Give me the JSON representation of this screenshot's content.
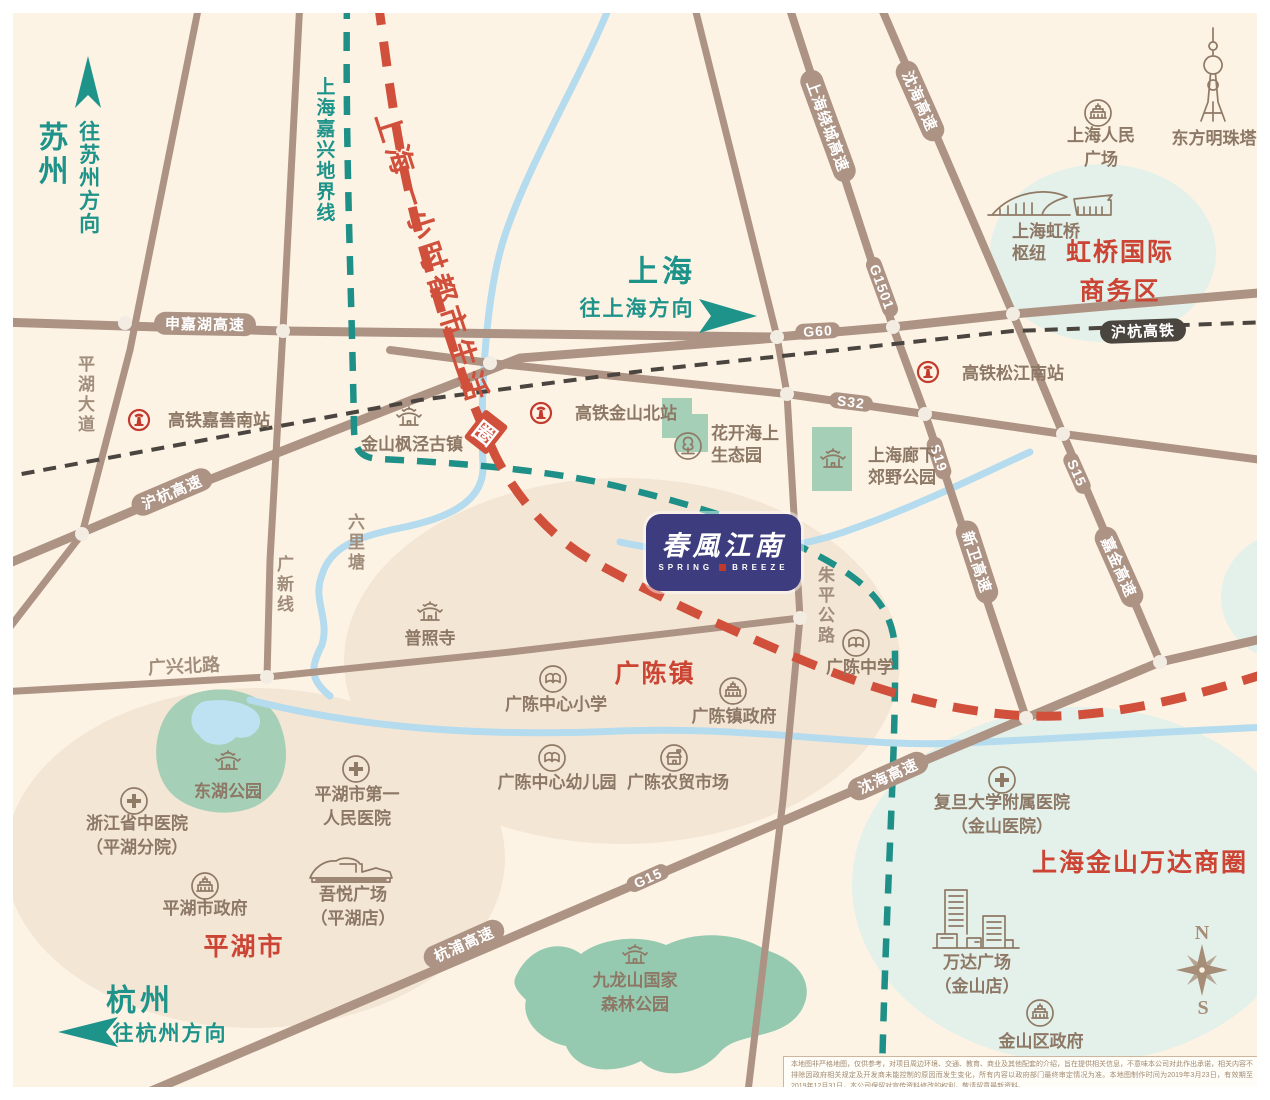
{
  "logo": {
    "cn": "春風江南",
    "en_left": "SPRING",
    "en_right": "BREEZE"
  },
  "directions": {
    "suzhou": "苏州",
    "to_suzhou": "往苏州方向",
    "shanghai": "上海",
    "to_shanghai": "往上海方向",
    "hangzhou": "杭州",
    "to_hangzhou": "往杭州方向"
  },
  "lines": {
    "boundary": "上海嘉兴地界线",
    "life_circle": "上海一小时都市生活",
    "life_circle_tail": "圈",
    "hsr": "沪杭高铁"
  },
  "roads": {
    "shenjiahu": "申嘉湖高速",
    "g60": "G60",
    "huhang": "沪杭高速",
    "s32": "S32",
    "raocheng": "上海绕城高速",
    "g1501": "G1501",
    "s19": "S19",
    "xinwei": "新卫高速",
    "shenhai_north": "沈海高速",
    "s15": "S15",
    "jiajin": "嘉金高速",
    "shenhai_south": "沈海高速",
    "g15": "G15",
    "hangpu": "杭浦高速",
    "pinghu_avenue": "平湖大道",
    "guangxin_line": "广新线",
    "liulitang": "六里塘",
    "zhuping_road": "朱平公路",
    "guangxing_road": "广兴北路"
  },
  "stations": {
    "jiashan_south": "高铁嘉善南站",
    "jinshan_north": "高铁金山北站",
    "songjiang_south": "高铁松江南站"
  },
  "areas": {
    "guangchen_town": "广陈镇",
    "pinghu_city": "平湖市",
    "hongqiao_line1": "虹桥国际",
    "hongqiao_line2": "商务区",
    "wanda_circle": "上海金山万达商圈"
  },
  "pois": {
    "fengjing": "金山枫泾古镇",
    "huakai_line1": "花开海上",
    "huakai_line2": "生态园",
    "langxia_line1": "上海廊下",
    "langxia_line2": "郊野公园",
    "puzhao": "普照寺",
    "gc_middle": "广陈中学",
    "gc_primary": "广陈中心小学",
    "gc_gov": "广陈镇政府",
    "gc_kindergarten": "广陈中心幼儿园",
    "gc_market": "广陈农贸市场",
    "donghu": "东湖公园",
    "zhongyi_line1": "浙江省中医院",
    "zhongyi_line2": "（平湖分院）",
    "renmin_hosp_line1": "平湖市第一",
    "renmin_hosp_line2": "人民医院",
    "pinghu_gov": "平湖市政府",
    "wuyue_line1": "吾悦广场",
    "wuyue_line2": "（平湖店）",
    "jiulongshan_line1": "九龙山国家",
    "jiulongshan_line2": "森林公园",
    "fudan_line1": "复旦大学附属医院",
    "fudan_line2": "（金山医院）",
    "wanda_line1": "万达广场",
    "wanda_line2": "（金山店）",
    "jinshan_gov": "金山区政府",
    "renmin_sq_line1": "上海人民",
    "renmin_sq_line2": "广场",
    "pearl_tower": "东方明珠塔",
    "hongqiao_hub_line1": "上海虹桥",
    "hongqiao_hub_line2": "枢纽"
  },
  "compass": {
    "north": "N",
    "south": "S"
  },
  "note": {
    "disclaimer": "本地图非严格地图，仅供参考，对项目周边环境、交通、教育、商业及其他配套的介绍，旨在提供相关信息，不意味本公司对此作出承诺，相关内容不排除因政府相关规定及开发商未能控制的原因而发生变化，所有内容以政府部门最终审定情况为准。本地图制作时间为2019年3月23日，有效期至2019年12月31日，本公司保留对宣传资料修改的权利，敬请留意最新资料。"
  }
}
